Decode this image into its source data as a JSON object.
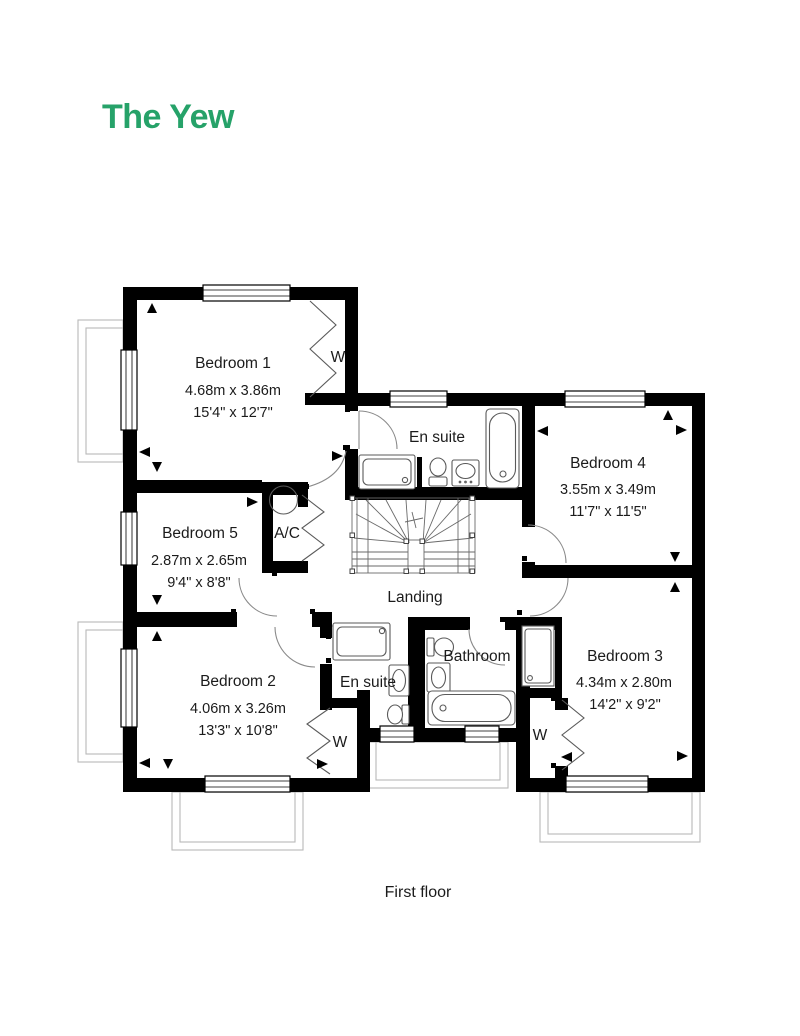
{
  "title": "The Yew",
  "caption": "First floor",
  "colors": {
    "accent": "#26A269",
    "wall": "#000000",
    "fixture_line": "#5a5a5a",
    "porch_outline": "#b9b9b9"
  },
  "rooms": [
    {
      "id": "bedroom-1",
      "name": "Bedroom 1",
      "metric": "4.68m x 3.86m",
      "imperial": "15'4\" x 12'7\""
    },
    {
      "id": "bedroom-5",
      "name": "Bedroom 5",
      "metric": "2.87m x 2.65m",
      "imperial": "9'4\" x 8'8\""
    },
    {
      "id": "bedroom-2",
      "name": "Bedroom 2",
      "metric": "4.06m x 3.26m",
      "imperial": "13'3\" x 10'8\""
    },
    {
      "id": "bedroom-4",
      "name": "Bedroom 4",
      "metric": "3.55m x 3.49m",
      "imperial": "11'7\" x 11'5\""
    },
    {
      "id": "bedroom-3",
      "name": "Bedroom 3",
      "metric": "4.34m x 2.80m",
      "imperial": "14'2\" x 9'2\""
    }
  ],
  "areas": {
    "ensuite1": "En suite",
    "ensuite2": "En suite",
    "bathroom": "Bathroom",
    "landing": "Landing",
    "airing_cupboard": "A/C",
    "wardrobe": "W"
  }
}
